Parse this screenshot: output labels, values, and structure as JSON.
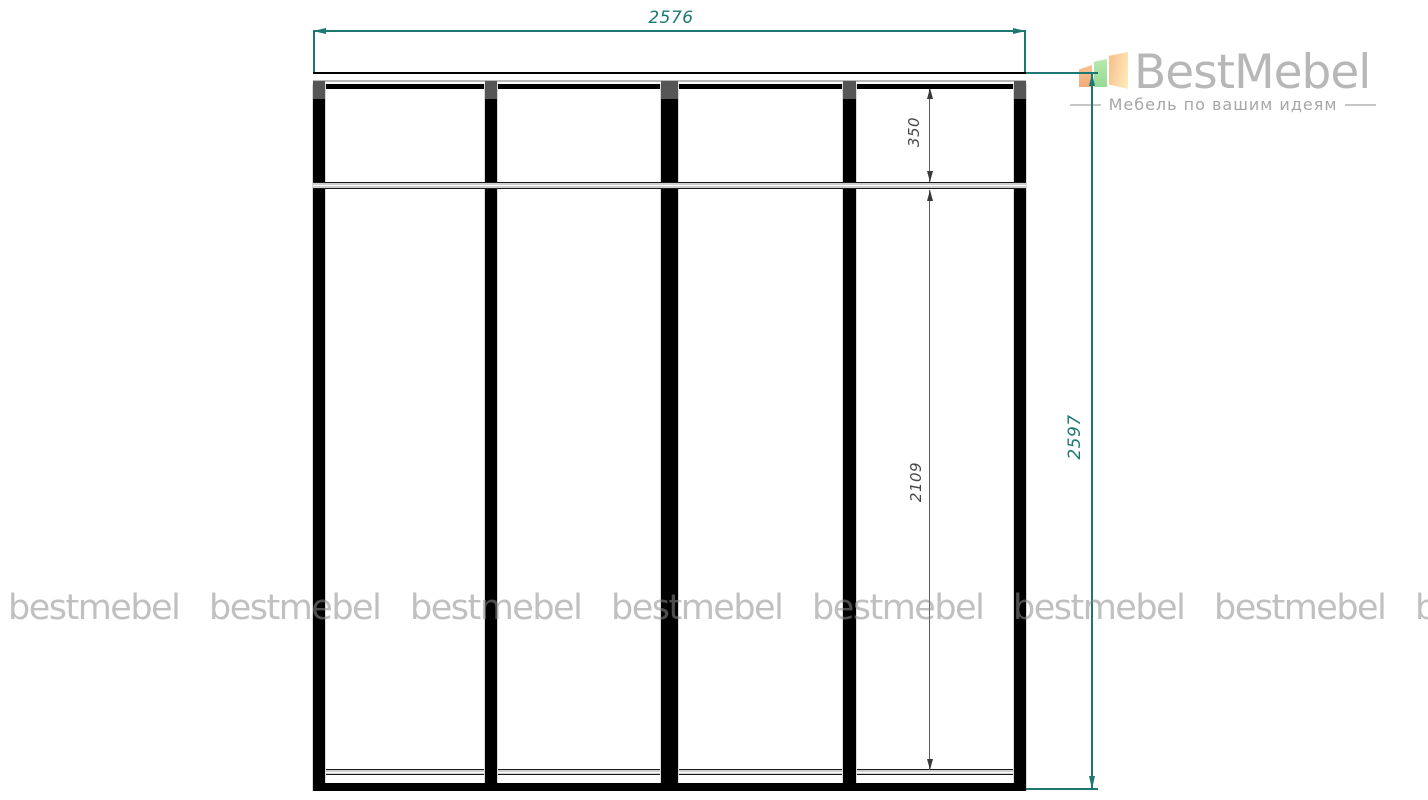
{
  "logo": {
    "brand": "BestMebel",
    "tagline": "Мебель по вашим идеям"
  },
  "watermark": {
    "text": "bestmebel"
  },
  "drawing": {
    "type": "wardrobe-front-elevation",
    "sections": 4,
    "dimensions": {
      "overall_width_mm": "2576",
      "overall_height_mm": "2597",
      "top_section_height_mm": "350",
      "lower_section_height_mm": "2109"
    }
  },
  "colors": {
    "dimension_accent_teal": "#1d7874",
    "dimension_gray": "#474747",
    "structure_black": "#000000",
    "watermark_gray": "#c0c0c0",
    "logo_text_gray": "#b7b7b7",
    "logo_orange": "#f2a977",
    "logo_green": "#96d996",
    "logo_yellow": "#fdeebc"
  }
}
